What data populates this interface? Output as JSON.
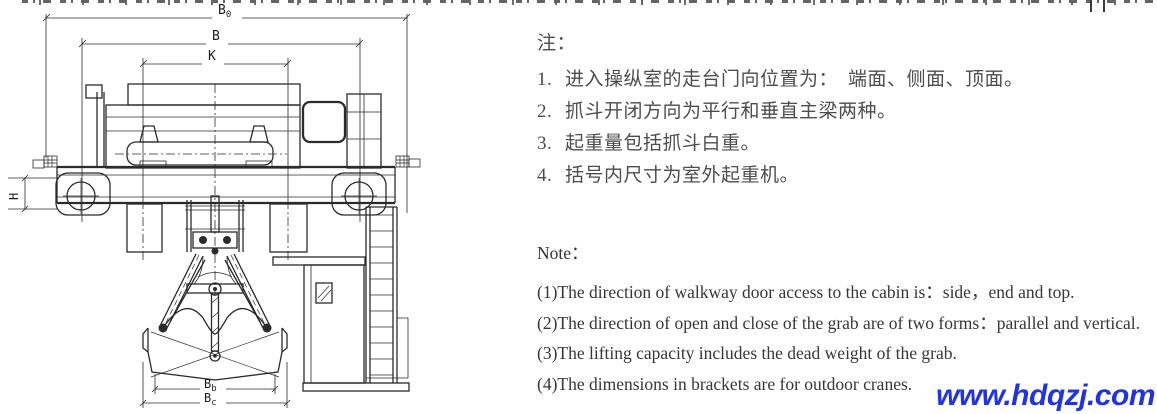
{
  "diagram": {
    "title_hint": "grab overhead crane end view drawing",
    "dims": {
      "b0": {
        "base": "B",
        "sub": "0"
      },
      "b": {
        "base": "B",
        "sub": ""
      },
      "k": {
        "base": "K",
        "sub": ""
      },
      "h": {
        "base": "H",
        "sub": ""
      },
      "bb": {
        "base": "B",
        "sub": "b"
      },
      "bc": {
        "base": "B",
        "sub": "c"
      }
    }
  },
  "notes_cn": {
    "title": "注：",
    "items": [
      {
        "no": "1.",
        "text": "进入操纵室的走台门向位置为：　端面、侧面、顶面。"
      },
      {
        "no": "2.",
        "text": "抓斗开闭方向为平行和垂直主梁两种。"
      },
      {
        "no": "3.",
        "text": "起重量包括抓斗白重。"
      },
      {
        "no": "4.",
        "text": "括号内尺寸为室外起重机。"
      }
    ]
  },
  "notes_en": {
    "title": "Note：",
    "items": [
      "(1)The direction of walkway door access to the cabin is：side，end and top.",
      "(2)The direction of open and close of the grab are of two forms：parallel and vertical.",
      "(3)The lifting capacity includes the dead weight of the grab.",
      "(4)The dimensions in brackets are for outdoor cranes."
    ]
  },
  "watermark": {
    "text": "www.hdqzj.com",
    "color": "#2233e0"
  }
}
